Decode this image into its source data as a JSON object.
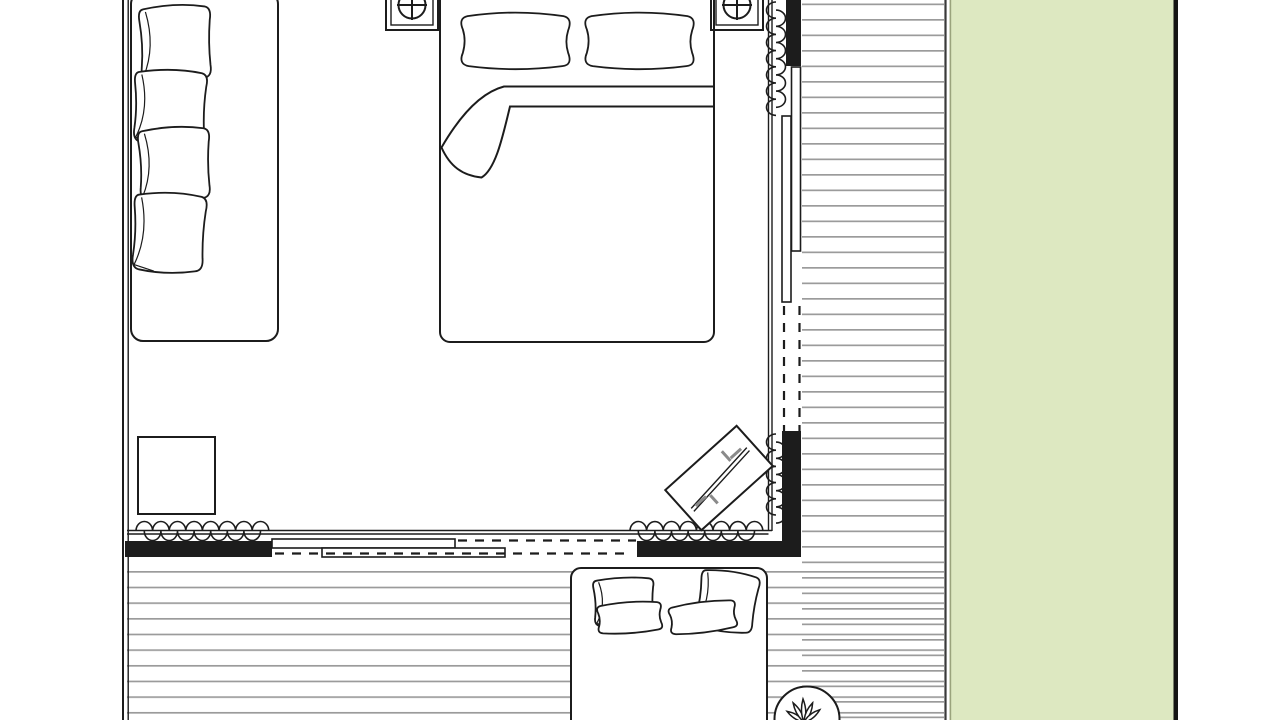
{
  "drawing": {
    "title": "Bedroom floor plan with timber deck and lawn strip",
    "kind": "architectural-floor-plan",
    "text_labels": []
  },
  "palette": {
    "line": "#1c1c1c",
    "deck_line": "#9b9b9b",
    "lawn": "#dde8c1",
    "lawn_border": "#141414",
    "lawn_edge": "#9aa37c",
    "deck_edge": "#3a3a3a",
    "rack_gray": "#8a8a8a",
    "background": "#ffffff"
  },
  "areas": [
    {
      "name": "bedroom",
      "floor": "plain-white"
    },
    {
      "name": "deck",
      "floor": "horizontal-plank-lines",
      "plank_spacing_px": 15.6
    },
    {
      "name": "lawn",
      "floor": "grass-green"
    }
  ],
  "furniture": [
    {
      "name": "daybed-bench",
      "location": "bedroom-left-wall",
      "cushions": 4
    },
    {
      "name": "double-bed",
      "location": "bedroom-top-wall",
      "pillows": 2,
      "duvet_corner_folded": true
    },
    {
      "name": "ceiling-speaker-left",
      "symbol": "square-circle-crosshair"
    },
    {
      "name": "ceiling-speaker-right",
      "symbol": "square-circle-crosshair"
    },
    {
      "name": "side-table",
      "location": "bedroom-bottom-left"
    },
    {
      "name": "clothes-rack",
      "location": "bedroom-bottom-right",
      "rotation_deg": -42,
      "hangers": 4
    },
    {
      "name": "outdoor-sofa",
      "location": "deck-bottom",
      "cushions": 4
    },
    {
      "name": "potted-plant",
      "location": "deck-bottom-right",
      "symbol": "circle-with-leaf-spray"
    }
  ],
  "openings": [
    {
      "name": "sliding-glass-door-right",
      "panels": 2,
      "state": "partially-open",
      "opening_shown": "dashed"
    },
    {
      "name": "sliding-glass-door-bottom",
      "panels": 2,
      "state": "partially-open",
      "opening_shown": "dashed"
    },
    {
      "name": "curtain-coil-top-right",
      "loops": 7
    },
    {
      "name": "curtain-coil-mid-right",
      "loops": 5
    },
    {
      "name": "curtain-coil-bottom-left",
      "loops": 8
    },
    {
      "name": "curtain-coil-bottom-center",
      "loops": 8
    }
  ],
  "walls": {
    "style": "solid-black-fill",
    "segments": [
      "right-top",
      "right-bottom",
      "bottom-left",
      "bottom-center-right",
      "left-double-line"
    ]
  }
}
